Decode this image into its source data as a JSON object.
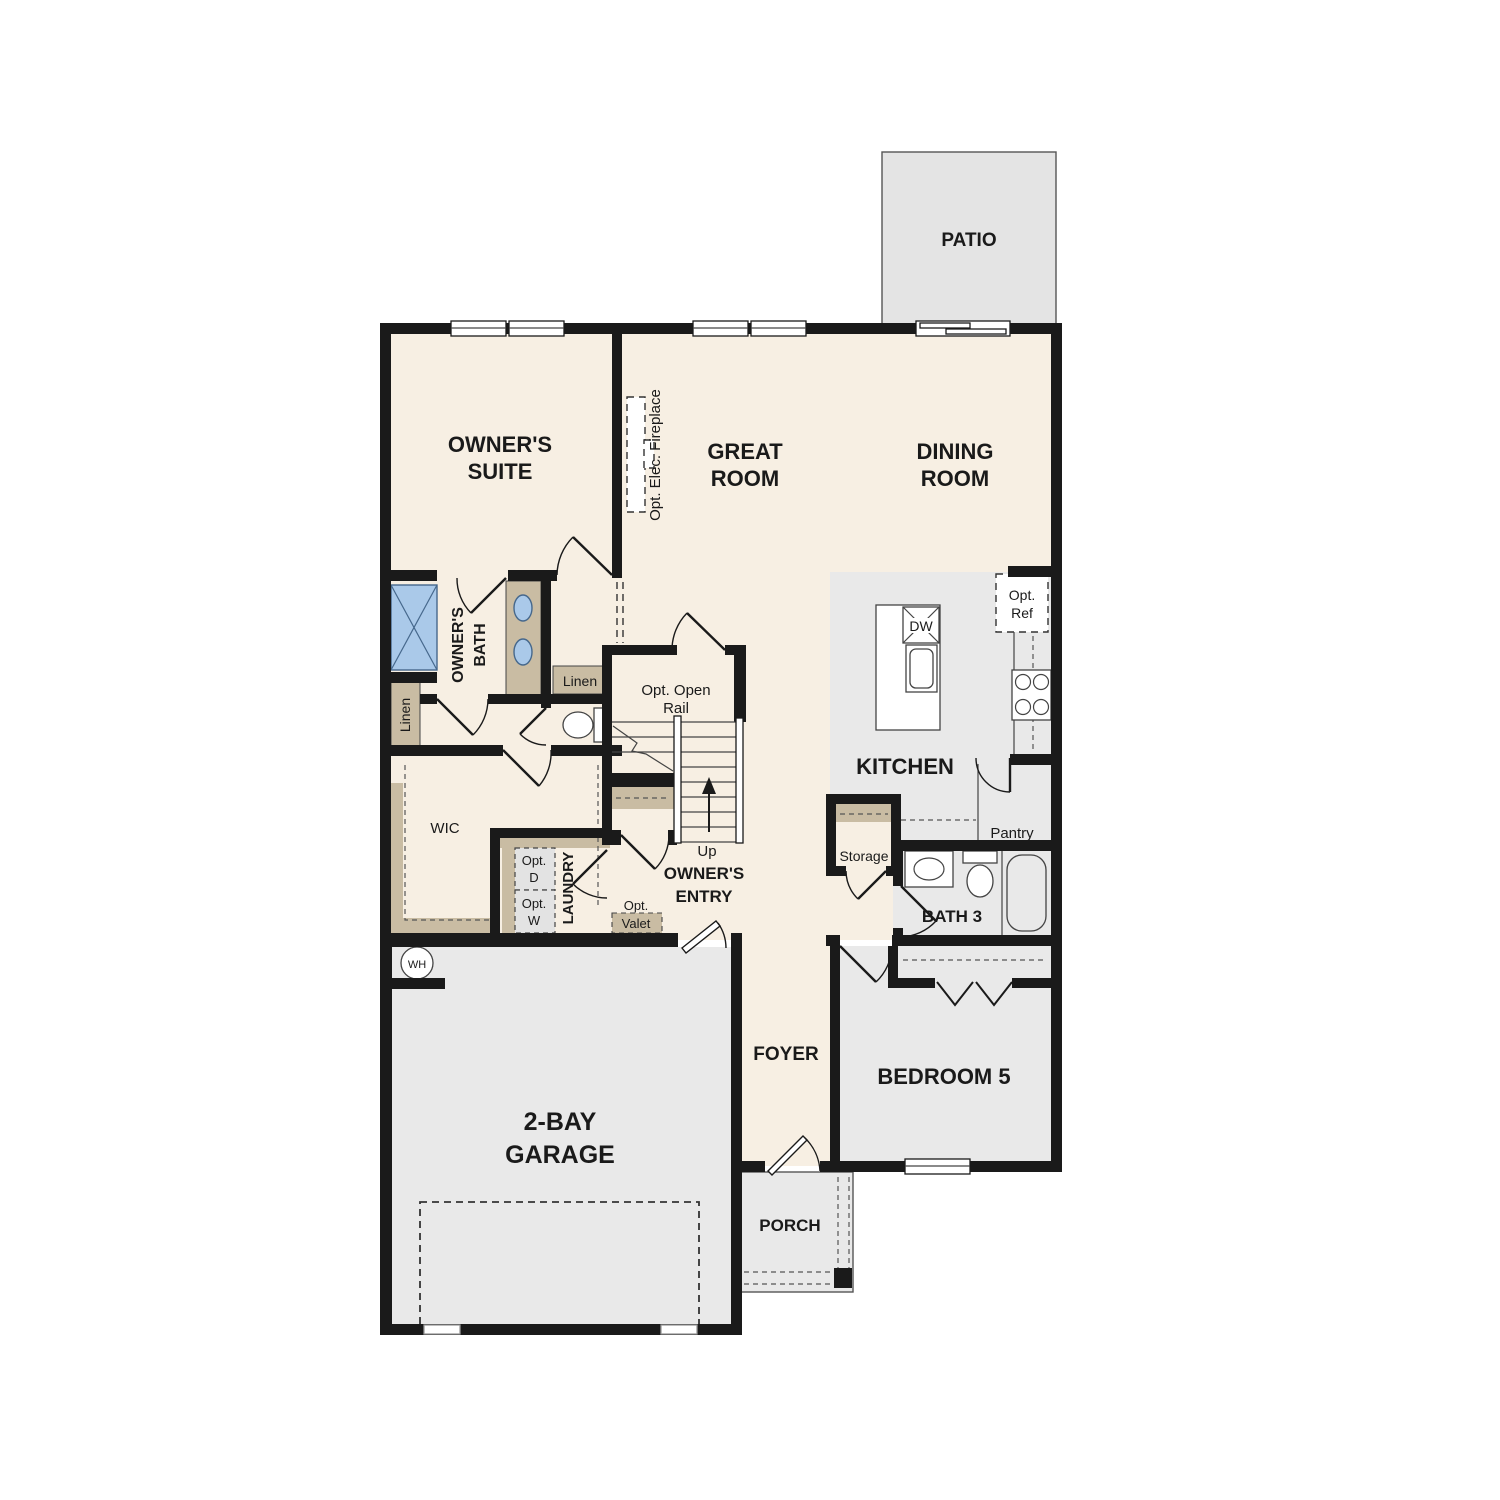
{
  "plan": {
    "rooms": {
      "patio": {
        "label": "PATIO"
      },
      "owners_suite": {
        "line1": "OWNER'S",
        "line2": "SUITE"
      },
      "great_room": {
        "line1": "GREAT",
        "line2": "ROOM"
      },
      "dining_room": {
        "line1": "DINING",
        "line2": "ROOM"
      },
      "kitchen": {
        "label": "KITCHEN"
      },
      "owners_bath": {
        "line1": "OWNER'S",
        "line2": "BATH"
      },
      "wic": {
        "label": "WIC"
      },
      "laundry": {
        "label": "LAUNDRY"
      },
      "owners_entry": {
        "line1": "OWNER'S",
        "line2": "ENTRY"
      },
      "storage": {
        "label": "Storage"
      },
      "bath3": {
        "label": "BATH 3"
      },
      "bedroom5": {
        "label": "BEDROOM 5"
      },
      "garage": {
        "line1": "2-BAY",
        "line2": "GARAGE"
      },
      "foyer": {
        "label": "FOYER"
      },
      "porch": {
        "label": "PORCH"
      }
    },
    "features": {
      "fireplace": {
        "label": "Opt. Elec. Fireplace"
      },
      "linen_bath": {
        "label": "Linen"
      },
      "linen_hall": {
        "label": "Linen"
      },
      "opt_ref": {
        "line1": "Opt.",
        "line2": "Ref"
      },
      "dw": {
        "label": "DW"
      },
      "pantry": {
        "label": "Pantry"
      },
      "opt_open_rail": {
        "line1": "Opt. Open",
        "line2": "Rail"
      },
      "up": {
        "label": "Up"
      },
      "opt_d": {
        "line1": "Opt.",
        "line2": "D"
      },
      "opt_w": {
        "line1": "Opt.",
        "line2": "W"
      },
      "opt_valet": {
        "line1": "Opt.",
        "line2": "Valet"
      },
      "wh": {
        "label": "WH"
      }
    },
    "colors": {
      "wall": "#1a1a1a",
      "floor_living": "#f7efe3",
      "floor_utility": "#e9e9e9",
      "patio": "#e4e4e4",
      "casework": "#c9bca3",
      "fixture_blue": "#aac9e9"
    }
  }
}
